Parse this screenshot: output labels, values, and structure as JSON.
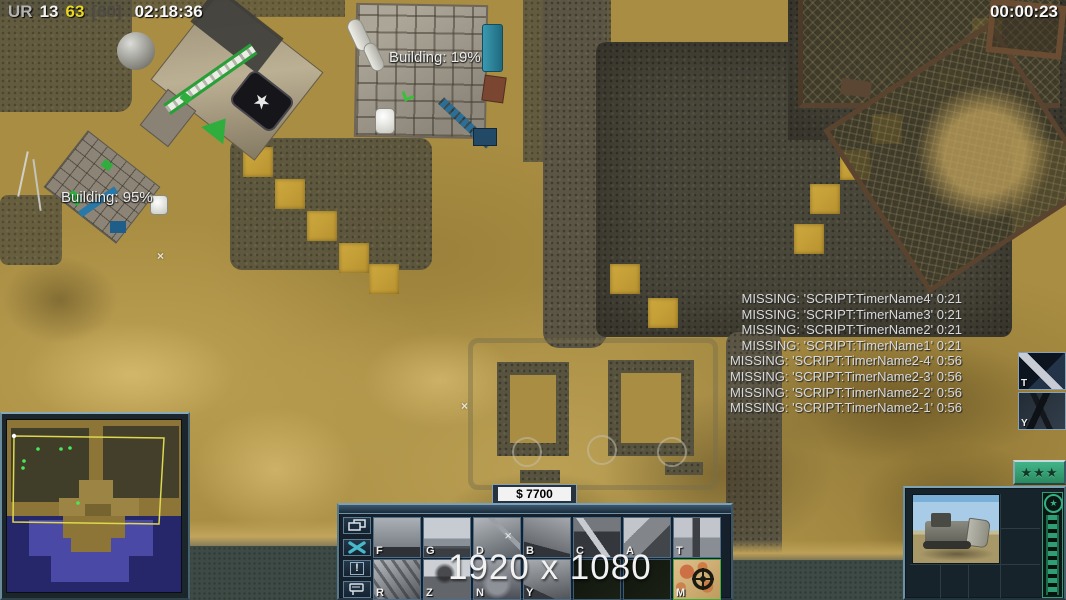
{
  "hud": {
    "faction_label": "UR",
    "stat_primary": "13",
    "stat_secondary": "63",
    "stat_tertiary": "[60]",
    "mission_timer": "02:18:36",
    "countdown_timer": "00:00:23"
  },
  "world_labels": {
    "construction_center": "Building: 19%",
    "construction_left": "Building: 95%"
  },
  "script_messages": [
    "MISSING: 'SCRIPT:TimerName4' 0:21",
    "MISSING: 'SCRIPT:TimerName3' 0:21",
    "MISSING: 'SCRIPT:TimerName2' 0:21",
    "MISSING: 'SCRIPT:TimerName1' 0:21",
    "MISSING: 'SCRIPT:TimerName2-4' 0:56",
    "MISSING: 'SCRIPT:TimerName2-3' 0:56",
    "MISSING: 'SCRIPT:TimerName2-2' 0:56",
    "MISSING: 'SCRIPT:TimerName2-1' 0:56"
  ],
  "debug_overlay": {
    "resolution": "1920 x 1080"
  },
  "resources": {
    "money": "$ 7700"
  },
  "command_bar": {
    "side_button_icons": [
      "windows-icon",
      "wrench-icon",
      "exclamation-icon",
      "beacon-icon"
    ],
    "alert_glyph": "!",
    "hotkeys_row1": [
      "F",
      "G",
      "D",
      "B",
      "C",
      "A",
      "T"
    ],
    "hotkeys_row2": [
      "R",
      "Z",
      "N",
      "Y",
      "",
      "",
      "M"
    ],
    "helipad_mark": "×"
  },
  "side_powers": {
    "power1_hotkey": "T",
    "power2_hotkey": "Y"
  },
  "unit_panel": {
    "rank_stars": "★★★",
    "veterancy_star": "★"
  },
  "world_marks": {
    "x_mark": "×"
  },
  "factory": {
    "emblem_star": "★"
  },
  "colors": {
    "sand": "#a88d42",
    "cobblestone": "#57533f",
    "ui_steel": "#5c7c94",
    "rank_green": "#2f9e74",
    "money_box_bg": "#f2f2f2",
    "minimap_water": "#26266a",
    "minimap_view_outline": "#ddd84e",
    "hotkey_highlight_yellow": "#e8d820"
  }
}
